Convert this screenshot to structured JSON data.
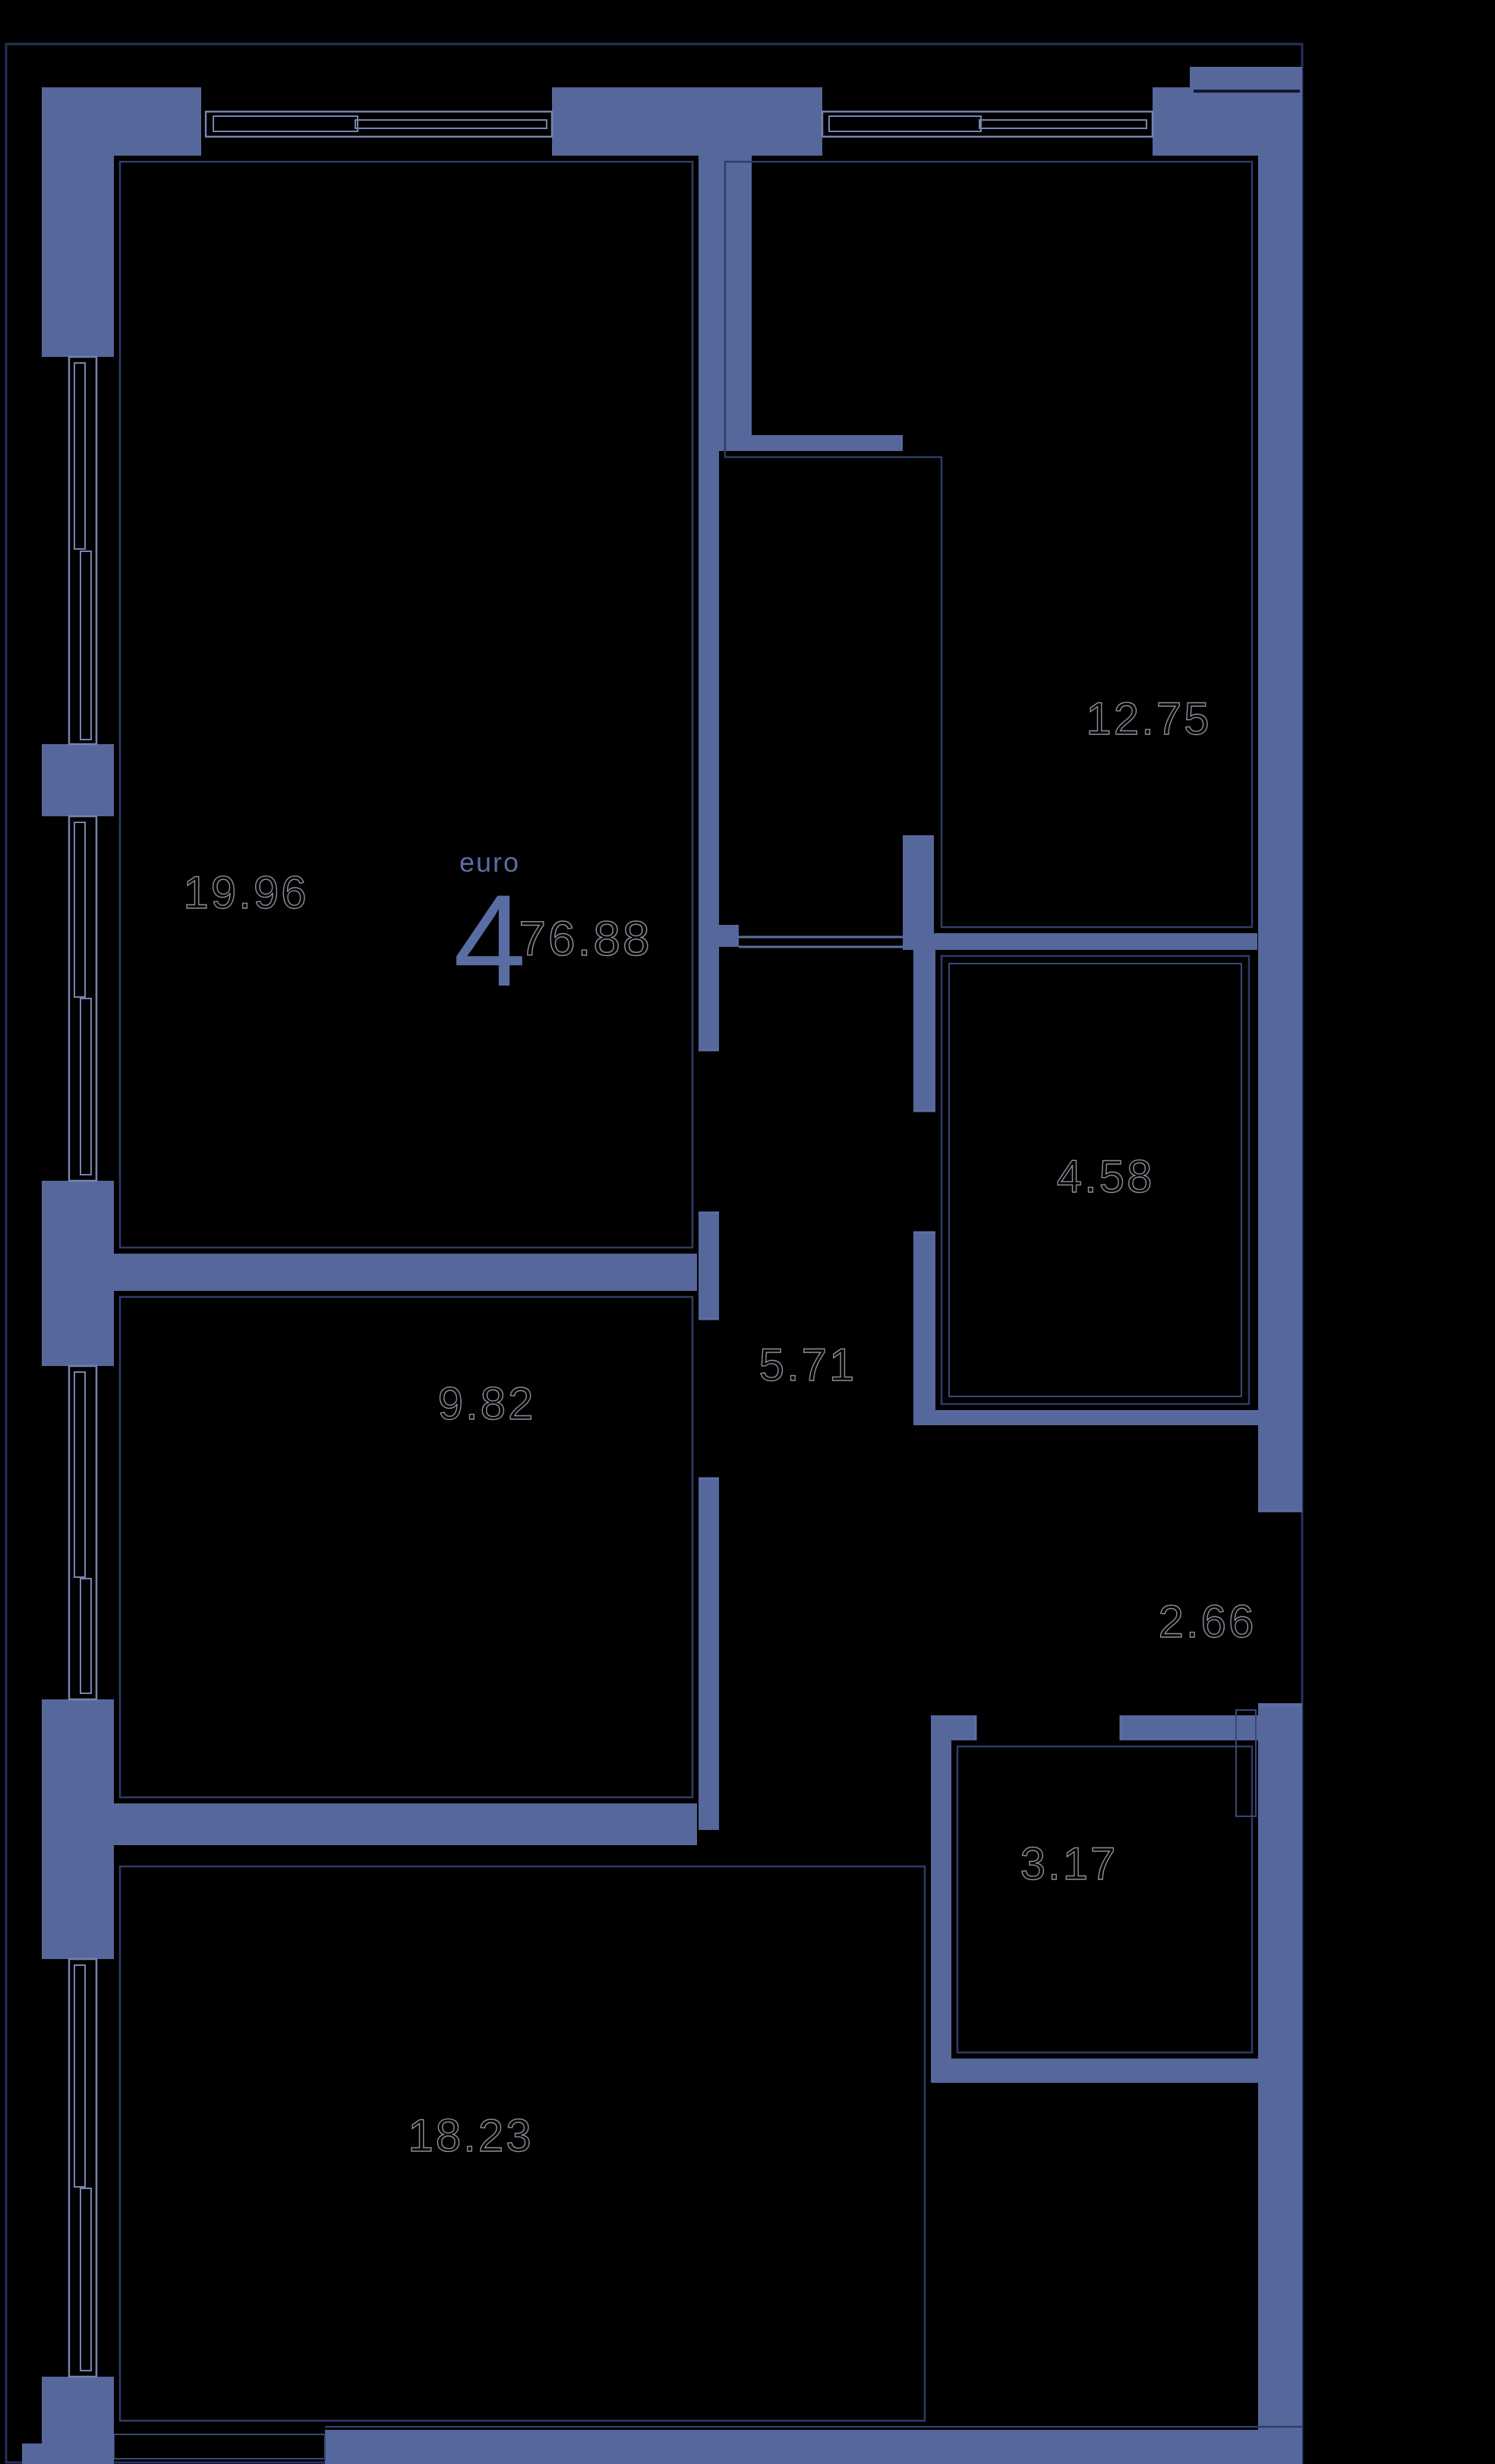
{
  "plan": {
    "unit_type_label": "euro",
    "unit_rooms_count": "4",
    "unit_total_area": "76.88",
    "room_areas": [
      "19.96",
      "12.75",
      "4.58",
      "5.71",
      "9.82",
      "2.66",
      "3.17",
      "18.23"
    ],
    "colors": {
      "background": "#000000",
      "wall": "#56679B",
      "outline": "#27325A",
      "thin_line": "#2F3C69",
      "window_frame": "#7484AF",
      "room_label_outline": "#8B9099",
      "accent_text": "#5A6DA3"
    }
  }
}
